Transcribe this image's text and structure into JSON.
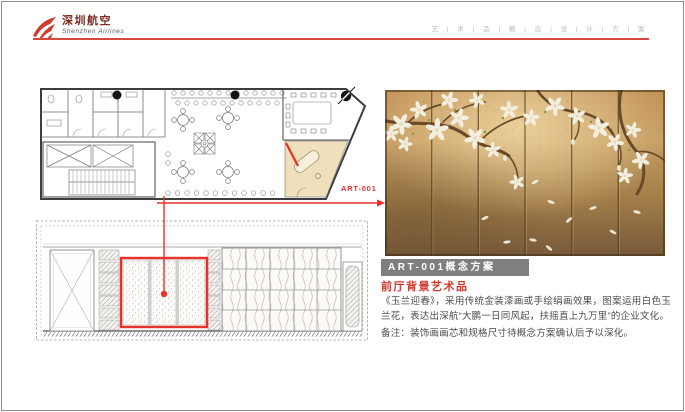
{
  "header": {
    "brand_cn": "深圳航空",
    "brand_en": "Shenzhen Airlines",
    "tagline": "艺 | 术 | 品 | 概 | 念 | 设 | 计 | 方 | 案",
    "rule_color": "#d6483e"
  },
  "plan": {
    "callout_label": "ART-001",
    "highlight_fill": "#efe0bb",
    "marker_color": "#e8312a"
  },
  "artwork": {
    "panel_count": 6,
    "gold_top": "#c59d63",
    "gold_bottom": "#77593a"
  },
  "detail": {
    "title_bar": "ART-001概念方案",
    "title_bar_bg": "#7f7f7f",
    "subtitle": "前厅背景艺术品",
    "subtitle_color": "#cf3a2e",
    "body": "《玉兰迎春》，采用传统金装漆画或手绘绢画效果，图案运用白色玉兰花，表达出深航“大鹏一日同风起，扶摇直上九万里”的企业文化。",
    "note": "备注：装饰画画芯和规格尺寸待概念方案确认后予以深化。"
  }
}
